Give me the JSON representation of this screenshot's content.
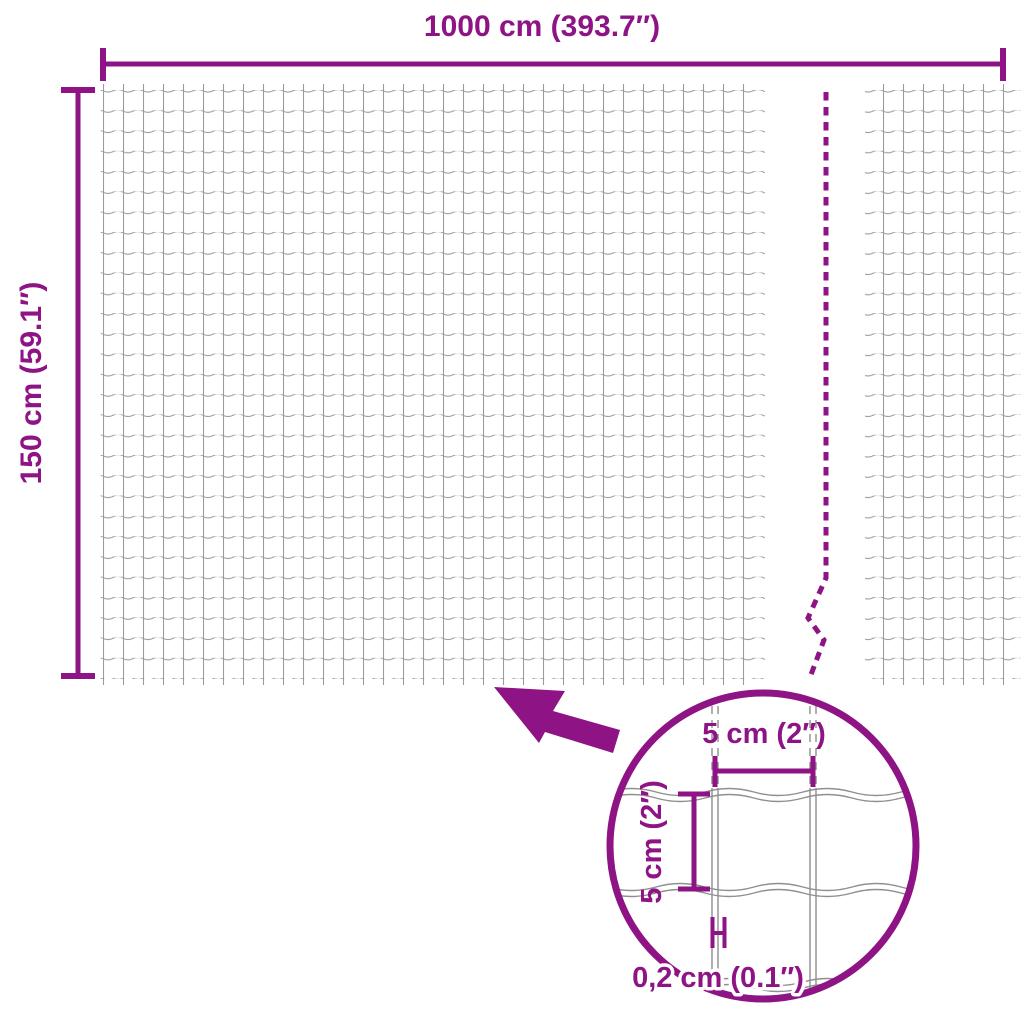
{
  "diagram": {
    "type": "product-dimension-diagram",
    "subject": "wire-mesh-fence",
    "colors": {
      "accent": "#8E1384",
      "wire": "#9A9A9A",
      "wire_detail": "#8F8F8F",
      "background": "#FFFFFF"
    },
    "labels": {
      "total_width": "1000 cm (393.7″)",
      "total_height": "150 cm (59.1″)",
      "cell_width": "5 cm (2″)",
      "cell_height": "5 cm (2″)",
      "wire_thickness": "0,2 cm (0.1″)"
    },
    "icons": {
      "zoom_arrow": "arrow-up-left-icon",
      "magnifier": "detail-circle",
      "break_line": "dashed-break-line"
    }
  }
}
